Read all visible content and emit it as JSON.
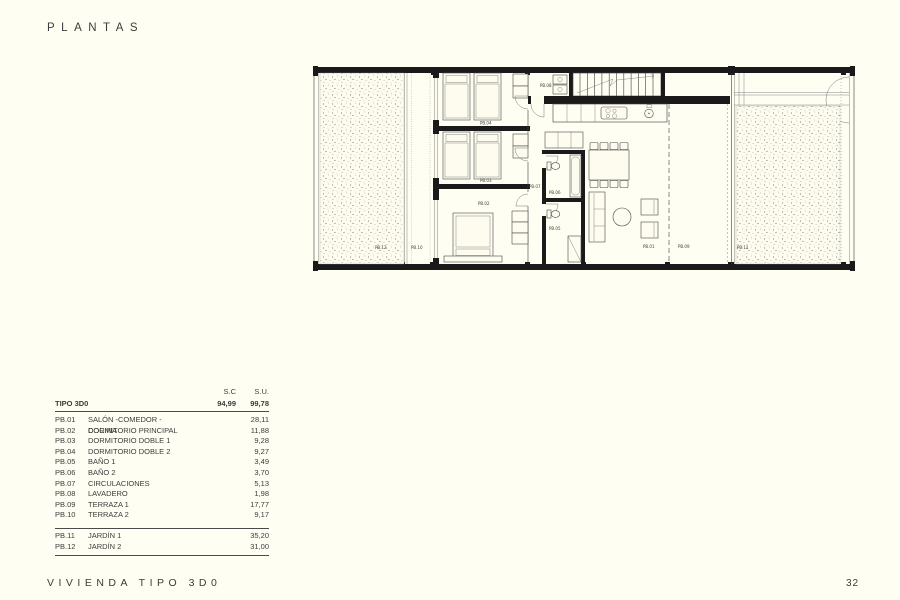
{
  "page": {
    "title": "PLANTAS",
    "footer_left": "VIVIENDA TIPO 3D0",
    "page_number": "32",
    "background_color": "#FFFEF2",
    "text_color": "#3C3C3C"
  },
  "area_table": {
    "columns": {
      "sc": "S.C",
      "su": "S.U."
    },
    "type_row": {
      "label": "TIPO 3D0",
      "sc": "94,99",
      "su": "99,78"
    },
    "rows": [
      {
        "code": "PB.01",
        "name": "SALÓN -COMEDOR - COCINA",
        "su": "28,11"
      },
      {
        "code": "PB.02",
        "name": "DORMITORIO PRINCIPAL",
        "su": "11,88"
      },
      {
        "code": "PB.03",
        "name": "DORMITORIO DOBLE 1",
        "su": "9,28"
      },
      {
        "code": "PB.04",
        "name": "DORMITORIO DOBLE 2",
        "su": "9,27"
      },
      {
        "code": "PB.05",
        "name": "BAÑO 1",
        "su": "3,49"
      },
      {
        "code": "PB.06",
        "name": "BAÑO 2",
        "su": "3,70"
      },
      {
        "code": "PB.07",
        "name": "CIRCULACIONES",
        "su": "5,13"
      },
      {
        "code": "PB.08",
        "name": "LAVADERO",
        "su": "1,98"
      },
      {
        "code": "PB.09",
        "name": "TERRAZA 1",
        "su": "17,77"
      },
      {
        "code": "PB.10",
        "name": "TERRAZA 2",
        "su": "9,17"
      }
    ],
    "outdoor_rows": [
      {
        "code": "PB.11",
        "name": "JARDÍN 1",
        "su": "35,20"
      },
      {
        "code": "PB.12",
        "name": "JARDÍN 2",
        "su": "31,00"
      }
    ]
  },
  "floor_plan": {
    "labels": {
      "salon": "PB.01",
      "dormitorio_principal": "PB.02",
      "dormitorio_doble1": "PB.03",
      "dormitorio_doble2": "PB.04",
      "bano1": "PB.05",
      "bano2": "PB.06",
      "circulaciones": "PB.07",
      "lavadero": "PB.08",
      "terraza1": "PB.09",
      "terraza2": "PB.10",
      "jardin1": "PB.11",
      "jardin2": "PB.12"
    }
  }
}
